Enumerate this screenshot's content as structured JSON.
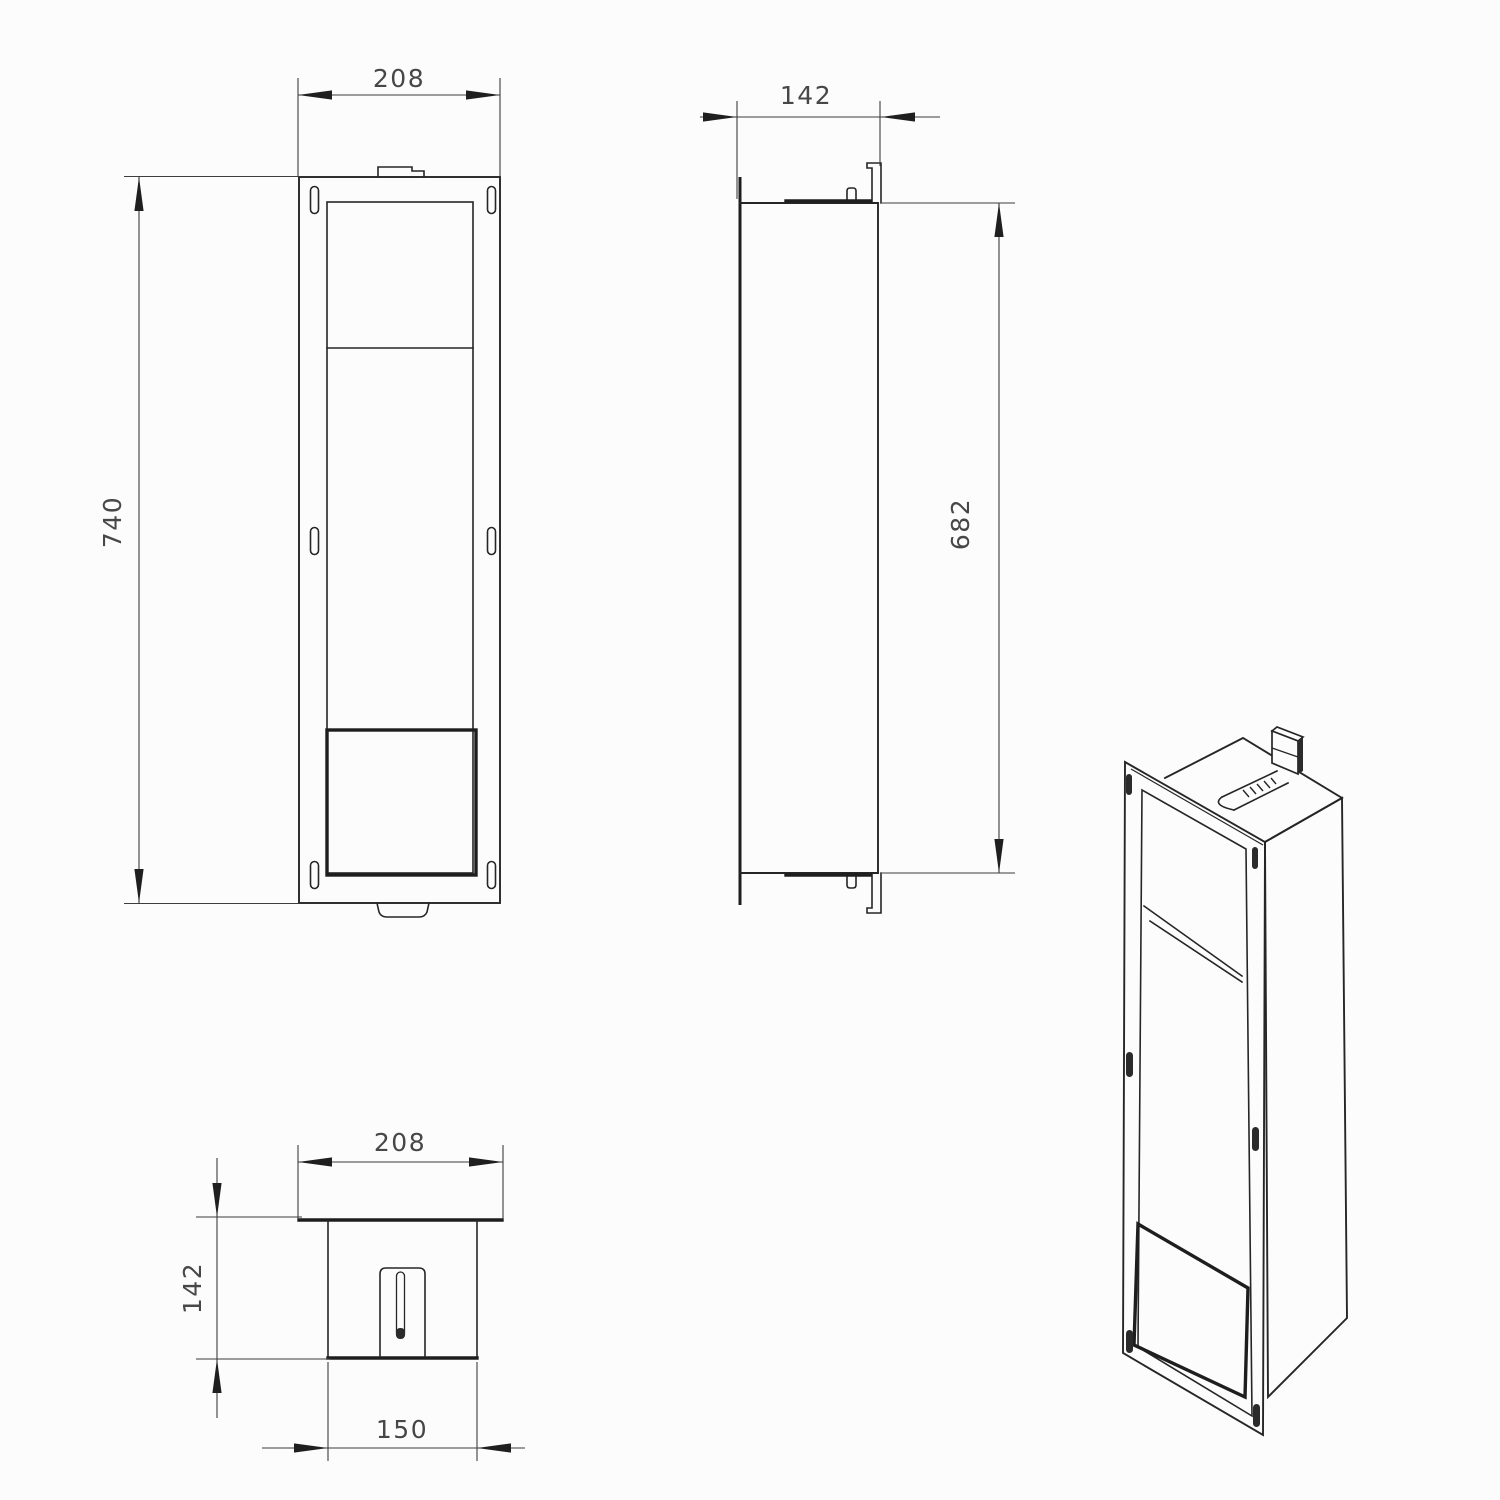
{
  "drawing": {
    "views": {
      "front": {
        "width_dim": "208",
        "height_dim": "740"
      },
      "side": {
        "depth_dim": "142",
        "height_dim": "682"
      },
      "plan": {
        "width_dim": "208",
        "depth_dim": "142",
        "inner_width_dim": "150"
      }
    },
    "colors": {
      "line": "#262626",
      "dimension_line": "#3d3d3d",
      "dimension_text": "#474747",
      "background": "#fcfcfc"
    }
  }
}
